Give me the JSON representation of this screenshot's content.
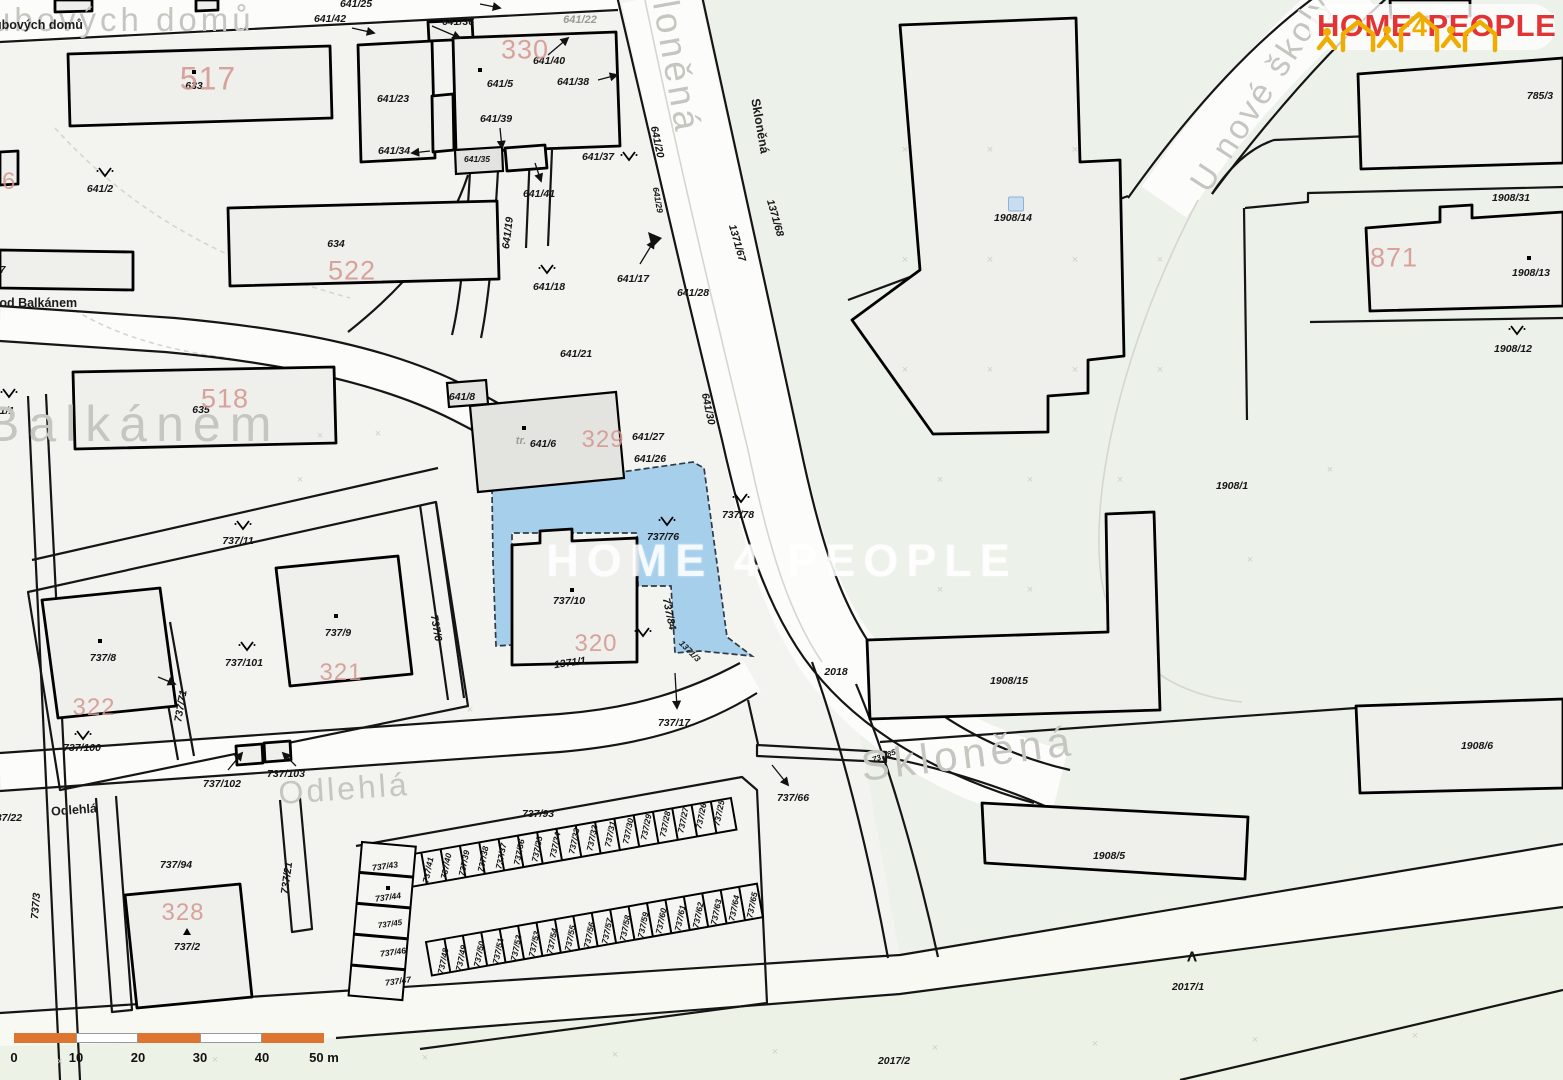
{
  "logo": {
    "home": "HOME",
    "four": "4",
    "people": "PEOPLE"
  },
  "watermark": "HOME 4 PEOPLE",
  "scale_bar": {
    "labels": [
      "0",
      "10",
      "20",
      "30",
      "40",
      "50 m"
    ],
    "bar_color": "#dd7430",
    "alt_color": "#ffffff",
    "step_px": 62
  },
  "colors": {
    "highlight_parcel": "#a6cfec",
    "red_number": "#d4958f",
    "street_gray": "#c6c6c0"
  },
  "highlight_parcel_number": "737/76",
  "streets_large": [
    {
      "t": "ubových domů",
      "x": -8,
      "y": 20,
      "s": 33,
      "a": "l",
      "ls": 4
    },
    {
      "t": "Balkánem",
      "x": -14,
      "y": 424,
      "s": 50,
      "a": "l",
      "ls": 9
    },
    {
      "t": "Odlehlá",
      "x": 344,
      "y": 789,
      "s": 32,
      "r": -4,
      "ls": 3
    },
    {
      "t": "Skloněná",
      "x": 672,
      "y": 42,
      "s": 37,
      "r": 80,
      "ls": 4
    },
    {
      "t": "Skloněná",
      "x": 968,
      "y": 754,
      "s": 42,
      "r": -7,
      "ls": 5
    },
    {
      "t": "U nové školy",
      "x": 1262,
      "y": 92,
      "s": 34,
      "r": -57,
      "ls": 3
    }
  ],
  "streets_small": [
    {
      "t": "ubových domů",
      "x": -6,
      "y": 25,
      "a": "l"
    },
    {
      "t": "Pod Balkánem",
      "x": -9,
      "y": 303,
      "a": "l"
    },
    {
      "t": "Odlehlá",
      "x": 74,
      "y": 810,
      "r": -4
    },
    {
      "t": "Skloněná",
      "x": 760,
      "y": 126,
      "r": 80
    }
  ],
  "gray_labels": [
    {
      "t": "641/22",
      "x": 580,
      "y": 20
    },
    {
      "t": "tr.",
      "x": 521,
      "y": 441
    }
  ],
  "red_numbers": [
    {
      "t": "517",
      "x": 208,
      "y": 79,
      "s": 32
    },
    {
      "t": "522",
      "x": 352,
      "y": 271,
      "s": 27
    },
    {
      "t": "518",
      "x": 225,
      "y": 399,
      "s": 27
    },
    {
      "t": "330",
      "x": 525,
      "y": 50,
      "s": 27
    },
    {
      "t": "329",
      "x": 603,
      "y": 440,
      "s": 24
    },
    {
      "t": "320",
      "x": 596,
      "y": 644,
      "s": 24
    },
    {
      "t": "321",
      "x": 341,
      "y": 673,
      "s": 24
    },
    {
      "t": "322",
      "x": 94,
      "y": 708,
      "s": 24
    },
    {
      "t": "328",
      "x": 183,
      "y": 913,
      "s": 24
    },
    {
      "t": "871",
      "x": 1394,
      "y": 258,
      "s": 27
    },
    {
      "t": "6",
      "x": 2,
      "y": 182,
      "s": 24,
      "a": "l"
    }
  ],
  "parcels": [
    {
      "t": "641/25",
      "x": 356,
      "y": 4
    },
    {
      "t": "641/42",
      "x": 330,
      "y": 19
    },
    {
      "t": "641/36",
      "x": 458,
      "y": 22
    },
    {
      "t": "641/40",
      "x": 549,
      "y": 61
    },
    {
      "t": "641/5",
      "x": 500,
      "y": 84
    },
    {
      "t": "641/38",
      "x": 573,
      "y": 82
    },
    {
      "t": "641/23",
      "x": 393,
      "y": 99
    },
    {
      "t": "641/39",
      "x": 496,
      "y": 119
    },
    {
      "t": "641/34",
      "x": 394,
      "y": 151
    },
    {
      "t": "641/35",
      "x": 477,
      "y": 159,
      "s": 8.5
    },
    {
      "t": "641/37",
      "x": 598,
      "y": 157
    },
    {
      "t": "641/41",
      "x": 539,
      "y": 194
    },
    {
      "t": "641/19",
      "x": 508,
      "y": 233,
      "r": -83
    },
    {
      "t": "641/2",
      "x": 100,
      "y": 189
    },
    {
      "t": "633",
      "x": 194,
      "y": 86
    },
    {
      "t": "634",
      "x": 336,
      "y": 244
    },
    {
      "t": "635",
      "x": 201,
      "y": 410
    },
    {
      "t": "641/1",
      "x": -12,
      "y": 411,
      "a": "l"
    },
    {
      "t": "737",
      "x": -12,
      "y": 270,
      "a": "l"
    },
    {
      "t": "641/17",
      "x": 633,
      "y": 279
    },
    {
      "t": "641/18",
      "x": 549,
      "y": 287
    },
    {
      "t": "641/28",
      "x": 693,
      "y": 293
    },
    {
      "t": "641/20",
      "x": 657,
      "y": 142,
      "r": 78
    },
    {
      "t": "641/29",
      "x": 658,
      "y": 200,
      "r": 80,
      "s": 8.5
    },
    {
      "t": "641/21",
      "x": 576,
      "y": 354
    },
    {
      "t": "641/8",
      "x": 462,
      "y": 397
    },
    {
      "t": "641/6",
      "x": 543,
      "y": 444
    },
    {
      "t": "641/27",
      "x": 648,
      "y": 437
    },
    {
      "t": "641/26",
      "x": 650,
      "y": 459
    },
    {
      "t": "641/30",
      "x": 708,
      "y": 409,
      "r": 78
    },
    {
      "t": "1371/68",
      "x": 775,
      "y": 218,
      "r": 74
    },
    {
      "t": "1371/67",
      "x": 737,
      "y": 243,
      "r": 74
    },
    {
      "t": "737/11",
      "x": 238,
      "y": 541
    },
    {
      "t": "737/8",
      "x": 103,
      "y": 658
    },
    {
      "t": "737/9",
      "x": 338,
      "y": 633
    },
    {
      "t": "737/101",
      "x": 244,
      "y": 663
    },
    {
      "t": "737/100",
      "x": 82,
      "y": 748
    },
    {
      "t": "737/71",
      "x": 181,
      "y": 706,
      "r": -80
    },
    {
      "t": "737/6",
      "x": 436,
      "y": 628,
      "r": 80
    },
    {
      "t": "737/102",
      "x": 222,
      "y": 784
    },
    {
      "t": "737/103",
      "x": 286,
      "y": 774
    },
    {
      "t": "737/22",
      "x": -10,
      "y": 818,
      "a": "l"
    },
    {
      "t": "737/94",
      "x": 176,
      "y": 865
    },
    {
      "t": "737/2",
      "x": 187,
      "y": 947
    },
    {
      "t": "737/21",
      "x": 287,
      "y": 878,
      "r": -82
    },
    {
      "t": "737/3",
      "x": 36,
      "y": 906,
      "r": -85
    },
    {
      "t": "737/93",
      "x": 538,
      "y": 814
    },
    {
      "t": "737/10",
      "x": 569,
      "y": 601
    },
    {
      "t": "737/84",
      "x": 669,
      "y": 614,
      "r": 78
    },
    {
      "t": "1371/3",
      "x": 690,
      "y": 651,
      "r": 45,
      "s": 8.5
    },
    {
      "t": "1371/1",
      "x": 570,
      "y": 663,
      "r": -8
    },
    {
      "t": "737/76",
      "x": 663,
      "y": 537
    },
    {
      "t": "737/78",
      "x": 738,
      "y": 515
    },
    {
      "t": "737/17",
      "x": 674,
      "y": 723
    },
    {
      "t": "2018",
      "x": 836,
      "y": 672
    },
    {
      "t": "737/66",
      "x": 793,
      "y": 798
    },
    {
      "t": "737/85",
      "x": 884,
      "y": 756,
      "r": -20,
      "s": 8
    },
    {
      "t": "1908/14",
      "x": 1013,
      "y": 218
    },
    {
      "t": "1908/31",
      "x": 1511,
      "y": 198
    },
    {
      "t": "1908/13",
      "x": 1531,
      "y": 273
    },
    {
      "t": "1908/12",
      "x": 1513,
      "y": 349
    },
    {
      "t": "785/3",
      "x": 1540,
      "y": 96
    },
    {
      "t": "1908/1",
      "x": 1232,
      "y": 486
    },
    {
      "t": "1908/15",
      "x": 1009,
      "y": 681
    },
    {
      "t": "1908/5",
      "x": 1109,
      "y": 856
    },
    {
      "t": "1908/6",
      "x": 1477,
      "y": 746
    },
    {
      "t": "2017/1",
      "x": 1188,
      "y": 987
    },
    {
      "t": "2017/2",
      "x": 894,
      "y": 1061
    },
    {
      "t": "737/41",
      "x": 428,
      "y": 870,
      "r": -78,
      "s": 8.5
    },
    {
      "t": "737/40",
      "x": 446,
      "y": 866,
      "r": -78,
      "s": 8.5
    },
    {
      "t": "737/39",
      "x": 464,
      "y": 863,
      "r": -78,
      "s": 8.5
    },
    {
      "t": "737/38",
      "x": 483,
      "y": 859,
      "r": -78,
      "s": 8.5
    },
    {
      "t": "737/37",
      "x": 501,
      "y": 856,
      "r": -78,
      "s": 8.5
    },
    {
      "t": "737/36",
      "x": 519,
      "y": 852,
      "r": -78,
      "s": 8.5
    },
    {
      "t": "737/35",
      "x": 537,
      "y": 849,
      "r": -78,
      "s": 8.5
    },
    {
      "t": "737/34",
      "x": 555,
      "y": 845,
      "r": -78,
      "s": 8.5
    },
    {
      "t": "737/33",
      "x": 574,
      "y": 841,
      "r": -78,
      "s": 8.5
    },
    {
      "t": "737/32",
      "x": 592,
      "y": 838,
      "r": -78,
      "s": 8.5
    },
    {
      "t": "737/31",
      "x": 610,
      "y": 834,
      "r": -78,
      "s": 8.5
    },
    {
      "t": "737/30",
      "x": 628,
      "y": 831,
      "r": -78,
      "s": 8.5
    },
    {
      "t": "737/29",
      "x": 646,
      "y": 827,
      "r": -78,
      "s": 8.5
    },
    {
      "t": "737/28",
      "x": 665,
      "y": 824,
      "r": -78,
      "s": 8.5
    },
    {
      "t": "737/27",
      "x": 683,
      "y": 820,
      "r": -78,
      "s": 8.5
    },
    {
      "t": "737/26",
      "x": 701,
      "y": 816,
      "r": -78,
      "s": 8.5
    },
    {
      "t": "737/25",
      "x": 719,
      "y": 813,
      "r": -78,
      "s": 8.5
    },
    {
      "t": "737/43",
      "x": 385,
      "y": 866,
      "r": -8,
      "s": 8.5
    },
    {
      "t": "737/44",
      "x": 388,
      "y": 897,
      "r": -8,
      "s": 8.5
    },
    {
      "t": "737/45",
      "x": 390,
      "y": 924,
      "r": -8,
      "s": 8
    },
    {
      "t": "737/46",
      "x": 393,
      "y": 952,
      "r": -8,
      "s": 8.5
    },
    {
      "t": "737/47",
      "x": 398,
      "y": 981,
      "r": -8,
      "s": 8.5
    },
    {
      "t": "737/48",
      "x": 443,
      "y": 961,
      "r": -78,
      "s": 8.5
    },
    {
      "t": "737/49",
      "x": 461,
      "y": 958,
      "r": -78,
      "s": 8.5
    },
    {
      "t": "737/50",
      "x": 479,
      "y": 954,
      "r": -78,
      "s": 8.5
    },
    {
      "t": "737/51",
      "x": 498,
      "y": 951,
      "r": -78,
      "s": 8.5
    },
    {
      "t": "737/52",
      "x": 516,
      "y": 948,
      "r": -78,
      "s": 8.5
    },
    {
      "t": "737/53",
      "x": 534,
      "y": 944,
      "r": -78,
      "s": 8.5
    },
    {
      "t": "737/54",
      "x": 552,
      "y": 941,
      "r": -78,
      "s": 8.5
    },
    {
      "t": "737/55",
      "x": 570,
      "y": 938,
      "r": -78,
      "s": 8.5
    },
    {
      "t": "737/56",
      "x": 589,
      "y": 935,
      "r": -78,
      "s": 8.5
    },
    {
      "t": "737/57",
      "x": 607,
      "y": 931,
      "r": -78,
      "s": 8.5
    },
    {
      "t": "737/58",
      "x": 625,
      "y": 928,
      "r": -78,
      "s": 8.5
    },
    {
      "t": "737/59",
      "x": 643,
      "y": 925,
      "r": -78,
      "s": 8.5
    },
    {
      "t": "737/60",
      "x": 661,
      "y": 921,
      "r": -78,
      "s": 8.5
    },
    {
      "t": "737/61",
      "x": 680,
      "y": 918,
      "r": -78,
      "s": 8.5
    },
    {
      "t": "737/62",
      "x": 698,
      "y": 915,
      "r": -78,
      "s": 8.5
    },
    {
      "t": "737/63",
      "x": 716,
      "y": 912,
      "r": -78,
      "s": 8.5
    },
    {
      "t": "737/64",
      "x": 734,
      "y": 908,
      "r": -78,
      "s": 8.5
    },
    {
      "t": "737/65",
      "x": 752,
      "y": 905,
      "r": -78,
      "s": 8.5
    }
  ],
  "trees": [
    [
      105,
      172
    ],
    [
      9,
      393
    ],
    [
      629,
      156
    ],
    [
      547,
      269
    ],
    [
      243,
      525
    ],
    [
      247,
      646
    ],
    [
      83,
      735
    ],
    [
      667,
      521
    ],
    [
      741,
      498
    ],
    [
      643,
      632
    ],
    [
      1517,
      330
    ]
  ],
  "symbols": {
    "peak": {
      "t": "Λ",
      "x": 1192,
      "y": 957
    },
    "house_icon": {
      "x": 1016,
      "y": 204
    },
    "dots": [
      [
        194,
        72
      ],
      [
        480,
        70
      ],
      [
        572,
        590
      ],
      [
        336,
        616
      ],
      [
        100,
        641
      ],
      [
        524,
        428
      ],
      [
        388,
        888
      ],
      [
        1529,
        258
      ]
    ],
    "triangles": [
      [
        187,
        932
      ]
    ]
  }
}
